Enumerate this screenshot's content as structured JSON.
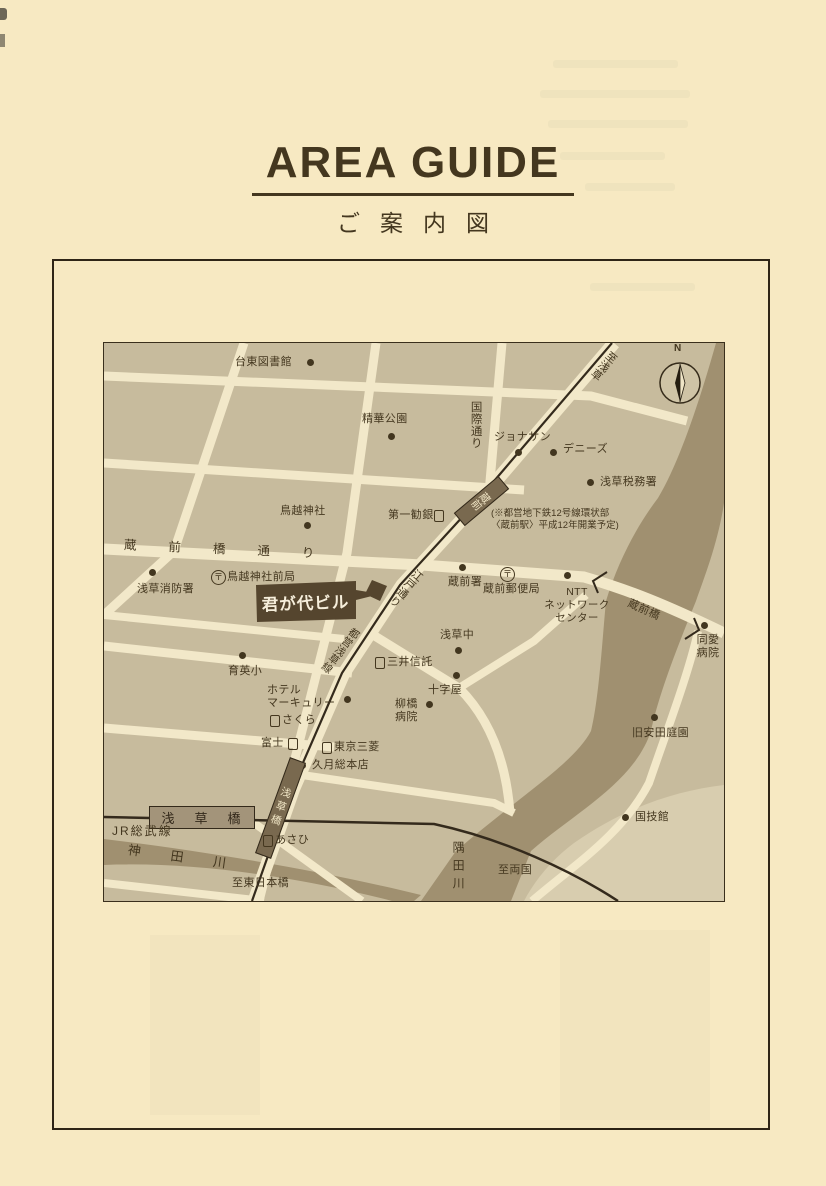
{
  "header": {
    "title": "AREA GUIDE",
    "subtitle": "ご案内図"
  },
  "colors": {
    "paper": "#f7e9c2",
    "ink": "#44371f",
    "map_background": "#c7bb9d",
    "road": "#f2e8c9",
    "river": "#a09070",
    "highlight_band": "#55452e"
  },
  "map": {
    "compass": "N",
    "post_mark": "〒",
    "labels": {
      "taito_library": "台東図書館",
      "seika_park": "精華公園",
      "to_asakusa": "至浅草",
      "kokusai_dori": "国際通り",
      "jonathan": "ジョナサン",
      "dennys": "デニーズ",
      "asakusa_tax_office": "浅草税務署",
      "daiichi_kangyo": "第一勧銀",
      "kuramae_station": "蔵前",
      "subway_note1": "(※都営地下鉄12号線環状部",
      "subway_note2": "〈蔵前駅〉平成12年開業予定)",
      "torigoe_shrine": "鳥越神社",
      "kuramaebashi_dori": "蔵前橋通り",
      "torigoe_post_office": "鳥越神社前局",
      "asakusa_fire_station": "浅草消防署",
      "kimigayo_building": "君が代ビル",
      "edo_dori": "江戸通り",
      "toei_asakusa_line": "都営浅草線",
      "kuramae_police": "蔵前署",
      "kuramae_post_office": "蔵前郵便局",
      "ntt1": "NTT",
      "ntt2": "ネットワーク",
      "ntt3": "センター",
      "kuramae_bridge": "蔵前橋",
      "doai1": "同愛",
      "doai2": "病院",
      "asakusa_jhs": "浅草中",
      "mitsui_trust": "三井信託",
      "jujiya": "十字屋",
      "yanagibashi1": "柳橋",
      "yanagibashi2": "病院",
      "ikuei_elementary": "育英小",
      "hotel1": "ホテル",
      "hotel2": "マーキュリー",
      "sakura_bank": "さくら",
      "fuji_bank": "富士",
      "tokyo_mitsubishi_bank": "東京三菱",
      "kugetsu": "久月総本店",
      "asakusabashi_subway": "浅草橋",
      "asakusabashi_jr": "浅草橋",
      "jr_sobu_line": "JR総武線",
      "kanda_river": "神田川",
      "asahi_bank": "あさひ",
      "to_higashi_nihonbashi": "至東日本橋",
      "to_ryogoku": "至両国",
      "sumida_river": "隅田川",
      "kokugikan": "国技館",
      "yasuda_garden": "旧安田庭園"
    }
  }
}
